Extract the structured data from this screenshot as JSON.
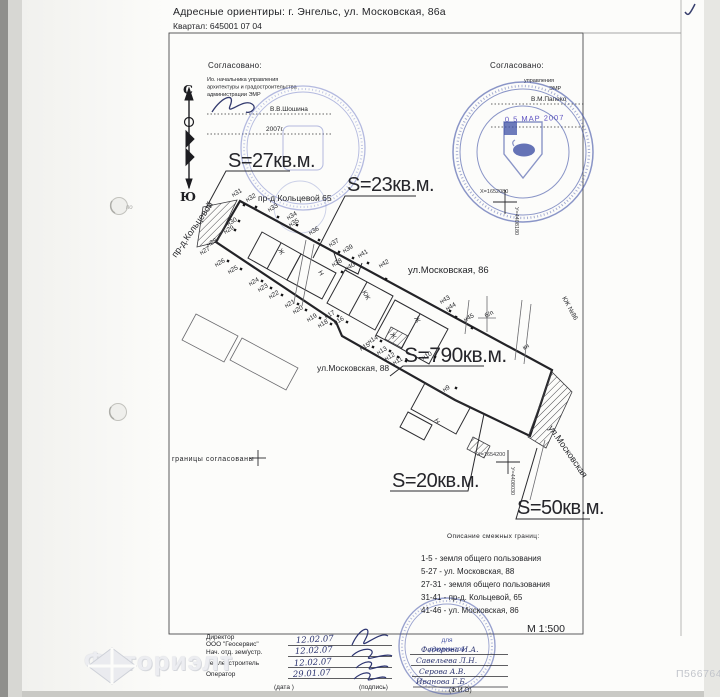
{
  "meta": {
    "scale": "М 1:500",
    "photo_id": "П566764",
    "watermark": "Фоториэлт"
  },
  "header": {
    "line1": "Адресные ориентиры: г. Энгельс, ул. Московская, 86а",
    "line2": "Квартал: 645001 07 04"
  },
  "approval_left": {
    "title": "Согласовано:",
    "line1": "Ио. начальника управления",
    "line2": "архитектуры и градостроительства",
    "line3": "администрации ЭМР",
    "name": "В.В.Шошина",
    "year": "2007г."
  },
  "approval_right": {
    "title": "Согласовано:",
    "line1": "управления",
    "line2": "ЭМР",
    "name": "В.М.Папеко",
    "date_stamp": "0 5 МАР 2007"
  },
  "stamp_bottom": {
    "line1": "для",
    "line2": "документов"
  },
  "compass": {
    "north": "С",
    "south": "Ю"
  },
  "boundary_note": "границы согласованы",
  "legend": {
    "title": "Описание смежных границ:",
    "items": [
      "1-5 - земля общего пользования",
      "5-27 - ул. Московская, 88",
      "27-31 - земля общего пользования",
      "31-41 - пр-д. Кольцевой, 65",
      "41-46 - ул. Московская, 86"
    ]
  },
  "table": {
    "rows": [
      {
        "role": "Директор",
        "role2": "ООО \"Геосервис\"",
        "date": "12.02.07",
        "name": "Федорова И.А."
      },
      {
        "role": "Нач. отд. зем/устр.",
        "date": "12.02.07",
        "name": "Савельева Л.Н."
      },
      {
        "role": "Землеустроитель",
        "date": "12.02.07",
        "name": "Серова А.В."
      },
      {
        "role": "Оператор",
        "date": "29.01.07",
        "name": "Иванова Г.Б."
      }
    ],
    "footer_date": "(дата )",
    "footer_sign": "(подпись)",
    "footer_name": "(Ф.И.О)"
  },
  "plan": {
    "labels": [
      {
        "t": "S=27кв.м.",
        "x": 228,
        "y": 167,
        "c": "big",
        "n": "area-label-27"
      },
      {
        "t": "S=23кв.м.",
        "x": 347,
        "y": 191,
        "c": "big",
        "n": "area-label-23"
      },
      {
        "t": "S=790кв.м.",
        "x": 404,
        "y": 362,
        "s": 21,
        "c": "big",
        "n": "area-label-790"
      },
      {
        "t": "S=20кв.м.",
        "x": 392,
        "y": 487,
        "c": "big",
        "n": "area-label-20"
      },
      {
        "t": "S=50кв.м.",
        "x": 517,
        "y": 514,
        "c": "big",
        "n": "area-label-50"
      },
      {
        "t": "пр-д Кольцевой 65",
        "x": 258,
        "y": 201,
        "s": 8.5,
        "c": "street",
        "n": "street-label"
      },
      {
        "t": "ул.Московская, 86",
        "x": 408,
        "y": 273,
        "s": 9.5,
        "c": "street",
        "n": "street-label"
      },
      {
        "t": "ул.Московская, 88",
        "x": 317,
        "y": 371,
        "s": 8.5,
        "c": "street",
        "n": "street-label"
      },
      {
        "t": "пр-д.Кольцевой",
        "x": 176,
        "y": 258,
        "r": -55,
        "c": "street",
        "n": "street-label"
      },
      {
        "t": "ул.Московская",
        "x": 548,
        "y": 428,
        "r": 55,
        "c": "street",
        "n": "street-label"
      },
      {
        "t": "б/п",
        "x": 486,
        "y": 318,
        "r": -29,
        "c": "pt",
        "n": "plan-note"
      },
      {
        "t": "кн",
        "x": 524,
        "y": 350,
        "r": -29,
        "c": "pt",
        "n": "plan-note"
      },
      {
        "t": "КЖ №86",
        "x": 562,
        "y": 298,
        "r": 61,
        "c": "bld",
        "n": "building-label"
      },
      {
        "t": "Ж",
        "x": 278,
        "y": 250,
        "r": 61,
        "c": "bld",
        "n": "building-label"
      },
      {
        "t": "Н",
        "x": 318,
        "y": 272,
        "r": 61,
        "c": "bld",
        "n": "building-label"
      },
      {
        "t": "КЖ",
        "x": 362,
        "y": 292,
        "r": 61,
        "c": "bld",
        "n": "building-label"
      },
      {
        "t": "Ж",
        "x": 414,
        "y": 318,
        "r": 61,
        "c": "bld",
        "n": "building-label"
      },
      {
        "t": "Ж",
        "x": 390,
        "y": 334,
        "r": 61,
        "c": "bld",
        "n": "building-label"
      },
      {
        "t": "Н",
        "x": 434,
        "y": 420,
        "r": 61,
        "c": "bld",
        "n": "building-label"
      },
      {
        "t": "Х=1652080",
        "x": 480,
        "y": 193,
        "c": "coord",
        "n": "grid-coordinate"
      },
      {
        "t": "У=4408180",
        "x": 515,
        "y": 207,
        "r": 90,
        "c": "coord",
        "n": "grid-coordinate"
      },
      {
        "t": "Х=1654200",
        "x": 477,
        "y": 456,
        "c": "coord",
        "n": "grid-coordinate"
      },
      {
        "t": "У=4408030",
        "x": 511,
        "y": 467,
        "r": 90,
        "c": "coord",
        "n": "grid-coordinate"
      },
      {
        "t": "по",
        "x": 126,
        "y": 209,
        "c": "ghost",
        "n": "margin-mark"
      },
      {
        "t": "н31",
        "x": 233,
        "y": 197,
        "r": -29,
        "c": "pt",
        "n": "boundary-point"
      },
      {
        "t": "н32",
        "x": 247,
        "y": 202,
        "r": -29,
        "c": "pt",
        "n": "boundary-point"
      },
      {
        "t": "н33",
        "x": 269,
        "y": 212,
        "r": -29,
        "c": "pt",
        "n": "boundary-point"
      },
      {
        "t": "н34",
        "x": 288,
        "y": 220,
        "r": -29,
        "c": "pt",
        "n": "boundary-point"
      },
      {
        "t": "н35",
        "x": 290,
        "y": 227,
        "r": -29,
        "c": "pt",
        "n": "boundary-point"
      },
      {
        "t": "н36",
        "x": 310,
        "y": 235,
        "r": -29,
        "c": "pt",
        "n": "boundary-point"
      },
      {
        "t": "н37",
        "x": 330,
        "y": 247,
        "r": -29,
        "c": "pt",
        "n": "boundary-point"
      },
      {
        "t": "н39",
        "x": 344,
        "y": 253,
        "r": -29,
        "c": "pt",
        "n": "boundary-point"
      },
      {
        "t": "н41",
        "x": 359,
        "y": 258,
        "r": -29,
        "c": "pt",
        "n": "boundary-point"
      },
      {
        "t": "н38",
        "x": 333,
        "y": 267,
        "r": -29,
        "c": "pt",
        "n": "boundary-point"
      },
      {
        "t": "н40",
        "x": 346,
        "y": 271,
        "r": -29,
        "c": "pt",
        "n": "boundary-point"
      },
      {
        "t": "н42",
        "x": 380,
        "y": 268,
        "r": -29,
        "c": "pt",
        "n": "boundary-point"
      },
      {
        "t": "н43",
        "x": 441,
        "y": 304,
        "r": -29,
        "c": "pt",
        "n": "boundary-point"
      },
      {
        "t": "н44",
        "x": 447,
        "y": 311,
        "r": -29,
        "c": "pt",
        "n": "boundary-point"
      },
      {
        "t": "н45",
        "x": 465,
        "y": 322,
        "r": -29,
        "c": "pt",
        "n": "boundary-point"
      },
      {
        "t": "н30",
        "x": 228,
        "y": 226,
        "r": -29,
        "c": "pt",
        "n": "boundary-point"
      },
      {
        "t": "н29",
        "x": 225,
        "y": 234,
        "r": -29,
        "c": "pt",
        "n": "boundary-point"
      },
      {
        "t": "н28",
        "x": 208,
        "y": 247,
        "r": -29,
        "c": "pt",
        "n": "boundary-point"
      },
      {
        "t": "н27",
        "x": 201,
        "y": 255,
        "r": -29,
        "c": "pt",
        "n": "boundary-point"
      },
      {
        "t": "н26",
        "x": 216,
        "y": 267,
        "r": -29,
        "c": "pt",
        "n": "boundary-point"
      },
      {
        "t": "н25",
        "x": 229,
        "y": 274,
        "r": -29,
        "c": "pt",
        "n": "boundary-point"
      },
      {
        "t": "н24",
        "x": 250,
        "y": 286,
        "r": -29,
        "c": "pt",
        "n": "boundary-point"
      },
      {
        "t": "н23",
        "x": 259,
        "y": 292,
        "r": -29,
        "c": "pt",
        "n": "boundary-point"
      },
      {
        "t": "н22",
        "x": 270,
        "y": 299,
        "r": -29,
        "c": "pt",
        "n": "boundary-point"
      },
      {
        "t": "н21",
        "x": 286,
        "y": 308,
        "r": -29,
        "c": "pt",
        "n": "boundary-point"
      },
      {
        "t": "н20",
        "x": 294,
        "y": 314,
        "r": -29,
        "c": "pt",
        "n": "boundary-point"
      },
      {
        "t": "н19",
        "x": 308,
        "y": 322,
        "r": -29,
        "c": "pt",
        "n": "boundary-point"
      },
      {
        "t": "н18",
        "x": 319,
        "y": 328,
        "r": -29,
        "c": "pt",
        "n": "boundary-point"
      },
      {
        "t": "н17",
        "x": 326,
        "y": 319,
        "r": -29,
        "c": "pt",
        "n": "boundary-point"
      },
      {
        "t": "н16",
        "x": 335,
        "y": 325,
        "r": -29,
        "c": "pt",
        "n": "boundary-point"
      },
      {
        "t": "н15",
        "x": 361,
        "y": 351,
        "r": -29,
        "c": "pt",
        "n": "boundary-point"
      },
      {
        "t": "н14",
        "x": 369,
        "y": 344,
        "r": -29,
        "c": "pt",
        "n": "boundary-point"
      },
      {
        "t": "н13",
        "x": 378,
        "y": 355,
        "r": -29,
        "c": "pt",
        "n": "boundary-point"
      },
      {
        "t": "н12",
        "x": 386,
        "y": 361,
        "r": -29,
        "c": "pt",
        "n": "boundary-point"
      },
      {
        "t": "н11",
        "x": 394,
        "y": 365,
        "r": -29,
        "c": "pt",
        "n": "boundary-point"
      },
      {
        "t": "н10",
        "x": 423,
        "y": 360,
        "r": -29,
        "c": "pt",
        "n": "boundary-point"
      },
      {
        "t": "н9",
        "x": 444,
        "y": 392,
        "r": -29,
        "c": "pt",
        "n": "boundary-point"
      }
    ],
    "markers": [
      [
        244,
        205
      ],
      [
        256,
        207
      ],
      [
        278,
        217
      ],
      [
        297,
        225
      ],
      [
        319,
        240
      ],
      [
        339,
        252
      ],
      [
        353,
        258
      ],
      [
        368,
        263
      ],
      [
        342,
        272
      ],
      [
        386,
        279
      ],
      [
        450,
        311
      ],
      [
        456,
        317
      ],
      [
        472,
        328
      ],
      [
        239,
        221
      ],
      [
        235,
        230
      ],
      [
        228,
        261
      ],
      [
        241,
        269
      ],
      [
        262,
        281
      ],
      [
        271,
        288
      ],
      [
        282,
        295
      ],
      [
        298,
        304
      ],
      [
        306,
        310
      ],
      [
        320,
        318
      ],
      [
        331,
        324
      ],
      [
        338,
        316
      ],
      [
        347,
        322
      ],
      [
        373,
        347
      ],
      [
        381,
        341
      ],
      [
        390,
        351
      ],
      [
        398,
        357
      ],
      [
        406,
        361
      ],
      [
        435,
        357
      ],
      [
        456,
        388
      ]
    ]
  }
}
